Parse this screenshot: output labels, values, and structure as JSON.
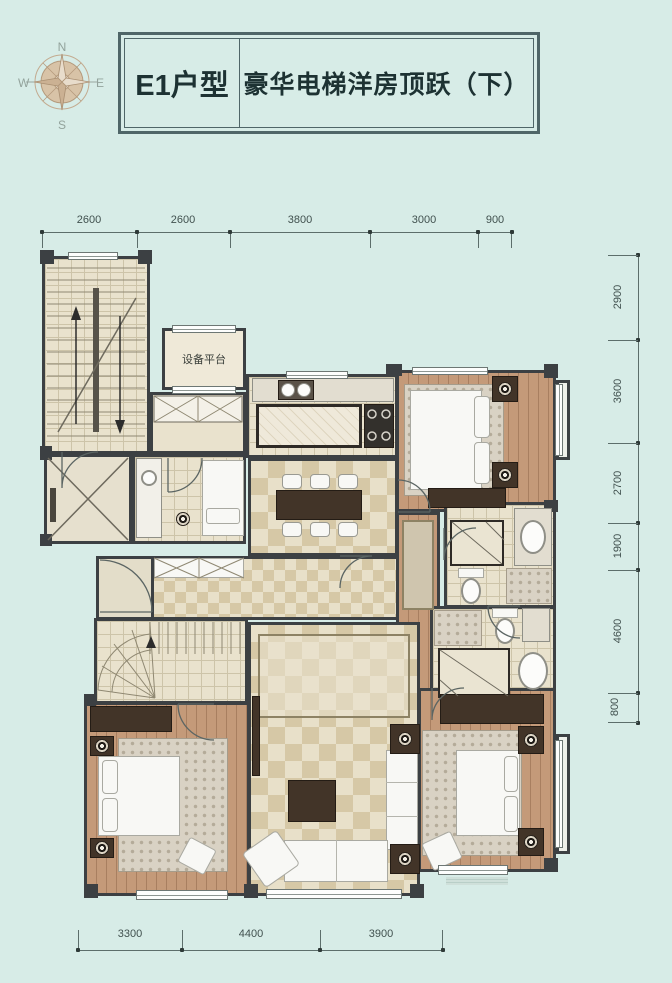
{
  "header": {
    "type_label": "E1户型",
    "title": "豪华电梯洋房顶跃（下）"
  },
  "compass": {
    "north": "N",
    "east": "E",
    "south": "S",
    "west": "W"
  },
  "dimensions": {
    "top": [
      "2600",
      "2600",
      "3800",
      "3000",
      "900"
    ],
    "right": [
      "2900",
      "3600",
      "2700",
      "1900",
      "4600",
      "800"
    ],
    "bottom": [
      "3300",
      "4400",
      "3900"
    ]
  },
  "plan": {
    "equipment_platform_label": "设备平台"
  },
  "colors": {
    "background": "#d7ece7",
    "wall": "#3c4043",
    "floor": "#e9e2cd",
    "tile_line": "#cdc4a9",
    "wood": "#c49a79",
    "wood_dark": "#423428",
    "marble_light": "#e8e0c9",
    "marble_dark": "#d6c8a6",
    "white_furniture": "#f8f8f5",
    "rug": "#d9d2c4",
    "title_text": "#1d3233",
    "dim_text": "#41514f",
    "box_border": "#4f6668",
    "compass_tan": "#c9ad92"
  }
}
